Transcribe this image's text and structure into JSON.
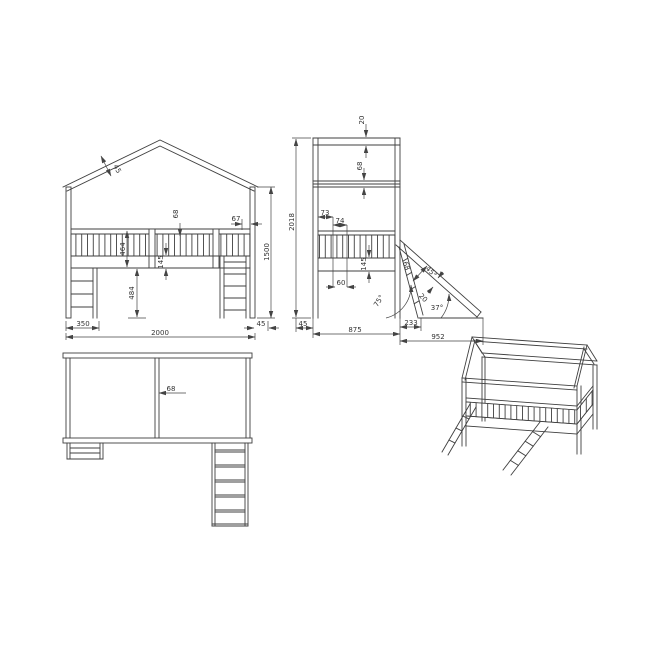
{
  "meta": {
    "background": "#ffffff",
    "line_color": "#3f3f3f"
  },
  "front": {
    "roof_thickness": "45",
    "slat_gap": "68",
    "end_gap": "67",
    "overall_height": "1500",
    "railing_height": "464",
    "frame_height": "145",
    "underbed_clearance": "484",
    "ladder_offset": "350",
    "overall_length": "2000",
    "post_width": "45"
  },
  "side": {
    "roof_beam_thickness": "20",
    "beam_gap": "68",
    "overall_height": "2018",
    "slat_offset": "73",
    "slat_pitch": "74",
    "frame_height": "145",
    "rung_width": "60",
    "post_width": "45",
    "overall_depth": "875",
    "ladder_foot_offset": "233",
    "slide_reach": "952",
    "ladder_angle": "75°",
    "ladder_width": "68",
    "slide_cross_dim": "45°",
    "slide_thickness": "20",
    "slide_angle": "37°"
  },
  "plan": {
    "divider_width": "68"
  }
}
